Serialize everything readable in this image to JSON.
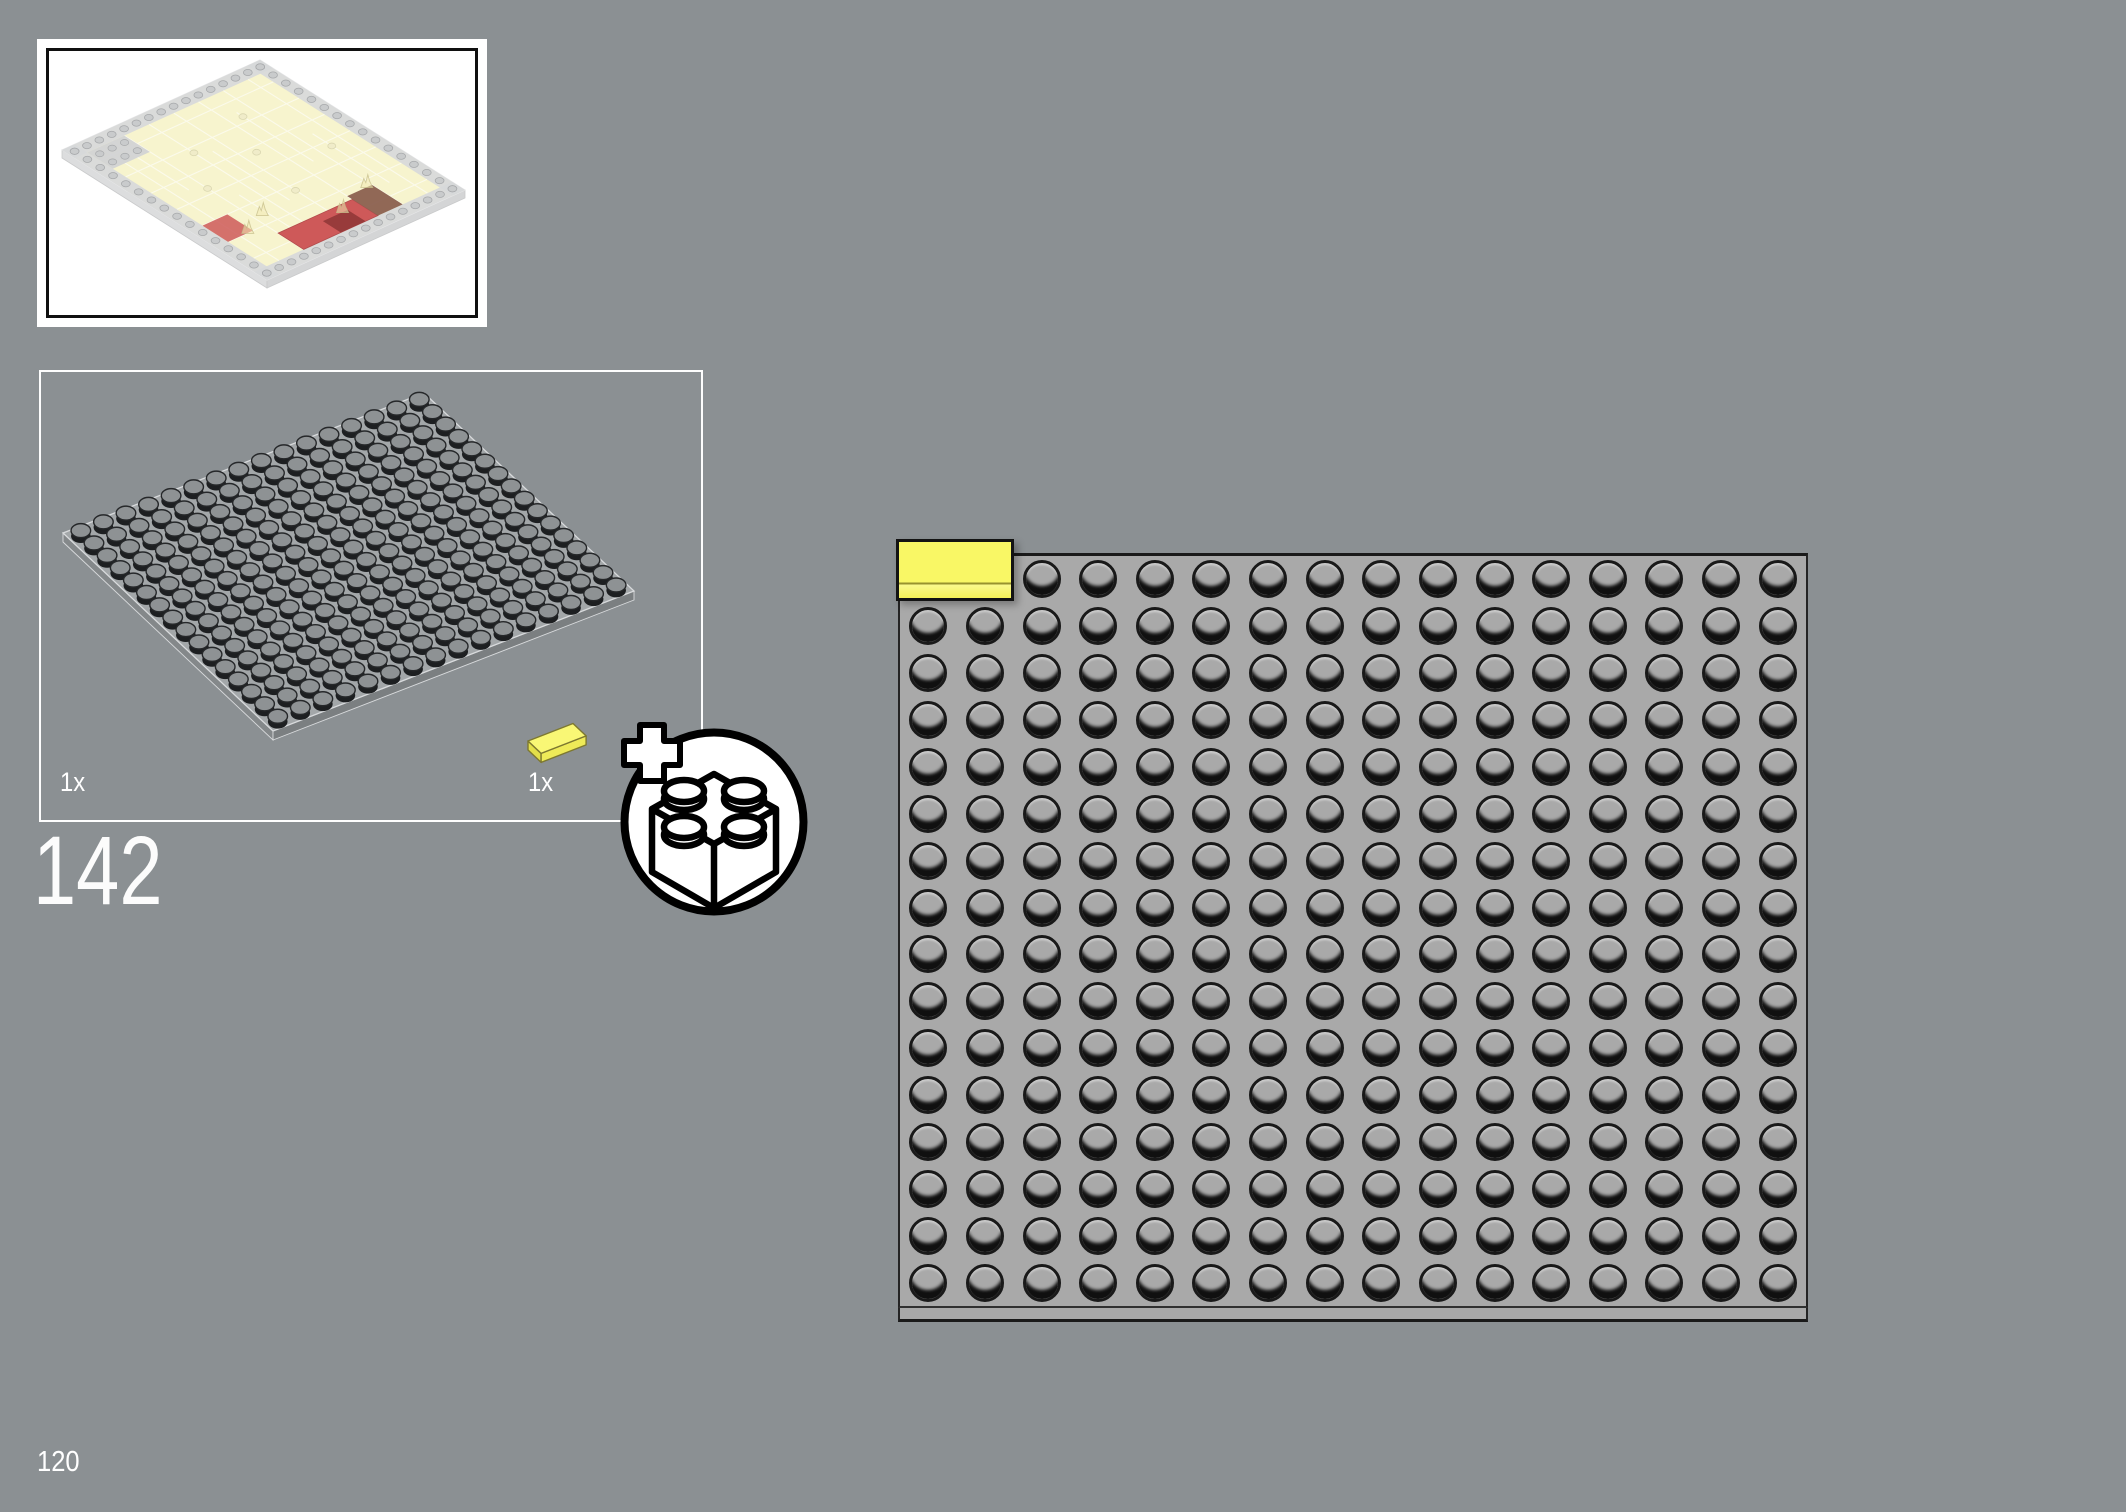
{
  "page": {
    "step_number": "142",
    "page_number": "120",
    "background": "#8b9093"
  },
  "preview_box": {
    "name": "subassembly-preview",
    "content": "isometric render of 16x16 plate covered with cream tiles, gray stud rim, red and brown patch near front corner"
  },
  "parts_box": {
    "items": [
      {
        "label": "1x",
        "part": "plate-16x16-gray"
      },
      {
        "label": "1x",
        "part": "tile-1x2-yellow"
      }
    ]
  },
  "callout_icon": {
    "name": "add-new-part",
    "glyphs": [
      "plus",
      "2x2-brick-outline"
    ]
  },
  "main_diagram": {
    "plate": {
      "cols": 16,
      "rows": 16,
      "color": "#a9a9a9"
    },
    "placed_tile": {
      "studs_wide": 2,
      "studs_tall": 1,
      "color": "#f9f765",
      "grid_position": "row 1, columns 1-2 (top-left corner)"
    }
  },
  "colors": {
    "background": "#8b9093",
    "white": "#ffffff",
    "outline": "#1a1a1a",
    "main_plate": "#a9a9a9",
    "stud_shadow": "#101010",
    "tile_yellow": "#f9f765",
    "tile_yellow_side": "#fbf98e",
    "tile_divider": "#98922e",
    "iso_face": "#a3a7a9",
    "iso_side": "#84888a",
    "iso_side2": "#7b7f81",
    "iso_edge": "#d8dadc",
    "iso_stud_dark": "#1d1f21",
    "iso_stud_top": "#8e9294",
    "iso_stud_ring": "#26282a",
    "cream": "#f6f3c8",
    "cream_line": "#ffffff",
    "rim": "#d2d4d6",
    "rim_stud": "#c2c4c6",
    "rim_stud_ring": "#9c9ea0",
    "red": "#c84343",
    "dark_red": "#8a2020",
    "brown": "#7b4b38",
    "flame": "rgba(240,230,170,0.55)",
    "flame_line": "rgba(190,180,120,0.75)"
  }
}
